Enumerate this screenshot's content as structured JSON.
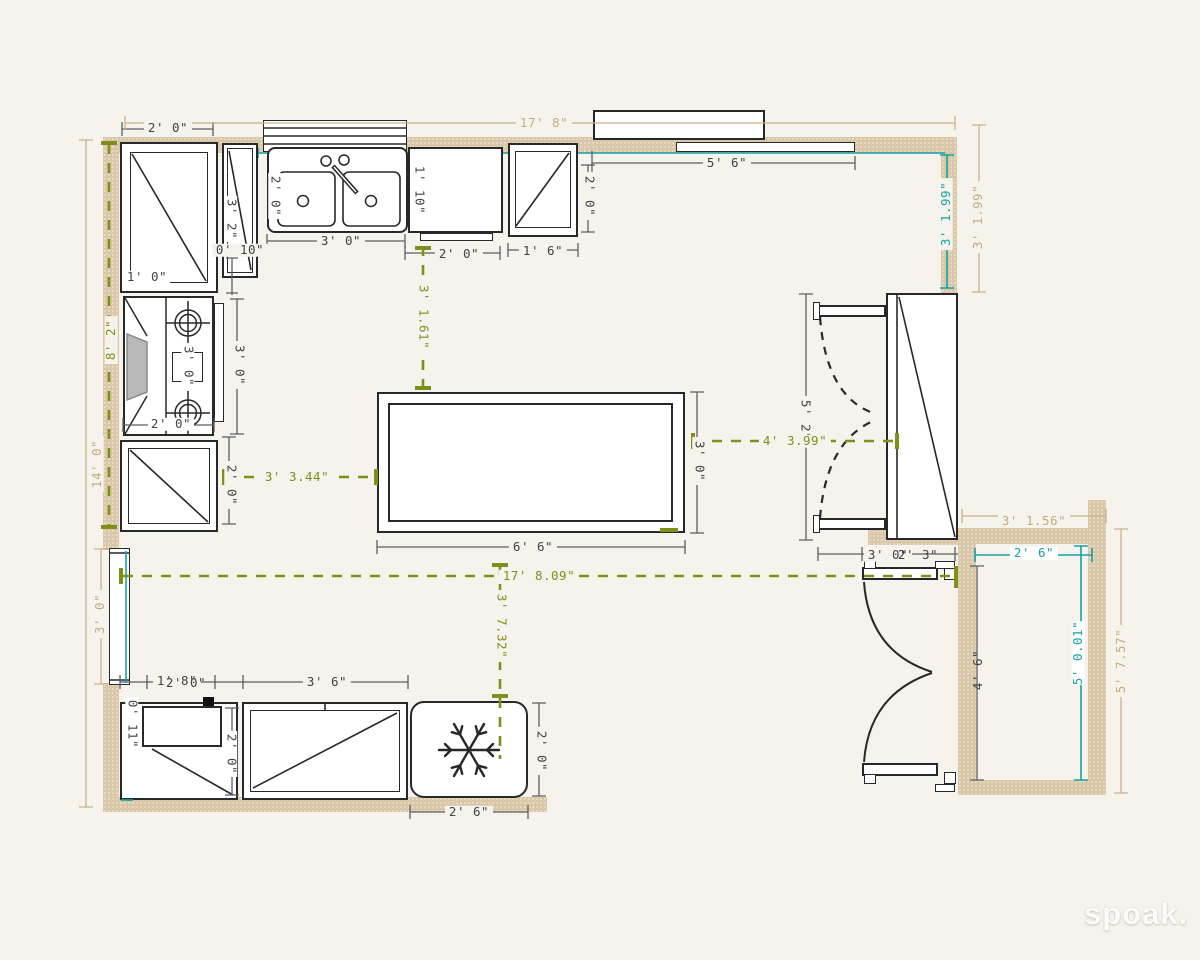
{
  "watermark": "spoak.",
  "colors": {
    "background": "#f6f3ec",
    "wall": "#d9c7a8",
    "fixture_line": "#26282a",
    "dimension_gray": "#5b5e63",
    "dimension_tan": "#c4ab80",
    "dimension_green": "#7e8f1c",
    "dimension_teal": "#12a3a6"
  },
  "icons": {
    "snowflake": "freezer snowflake glyph",
    "burners": "stove burner rings",
    "door_swing": "double door swing arcs"
  },
  "labels": {
    "dark": {
      "tl_cab_width": "2' 0\"",
      "tl_cab_depth": "1' 0\"",
      "narrow_cab_height": "3' 2\"",
      "narrow_cab_width": "0' 10\"",
      "sink_width": "3' 0\"",
      "sink_depth": "2' 0\"",
      "dishwasher_depth": "1' 10\"",
      "dishwasher_width": "2' 0\"",
      "upper_cab_width": "1' 6\"",
      "upper_cab_depth": "2' 0\"",
      "top_window_width": "5' 6\"",
      "stove_inner": "3' 0\"",
      "stove_height": "3' 0\"",
      "stove_width": "2' 0\"",
      "lower_left_cab_height": "2' 0\"",
      "island_width": "6' 6\"",
      "island_depth": "3' 0\"",
      "pantry_height": "5' 2\"",
      "below_pantry_a": "3' 0\"",
      "below_pantry_b": "2' 3\"",
      "closet_door_height": "4' 6\"",
      "bl_overlap_a": "1' 8\"",
      "bl_overlap_b": "2' 0\"",
      "bl_corner_depth": "0' 11\"",
      "bl_corner_height": "2' 0\"",
      "bl_cab_width": "3' 6\"",
      "freezer_height": "2' 0\"",
      "freezer_width": "2' 6\""
    },
    "green": {
      "left_wall_span": "8' 2\"",
      "dw_to_island": "3' 1.61\"",
      "cab_to_island": "3' 3.44\"",
      "island_to_door": "4' 3.99\"",
      "room_width": "17' 8.09\"",
      "line_to_freezer": "3' 7.32\""
    },
    "teal": {
      "right_top_span": "3' 1.99\"",
      "closet_width": "2' 6\"",
      "closet_height": "5' 0.01\""
    },
    "tan": {
      "top_wall_total": "17' 8\"",
      "right_top_span": "3' 1.99\"",
      "left_wall_total": "14' 0\"",
      "left_window": "3' 0\"",
      "closet_top": "3' 1.56\"",
      "closet_right": "5' 7.57\""
    }
  }
}
